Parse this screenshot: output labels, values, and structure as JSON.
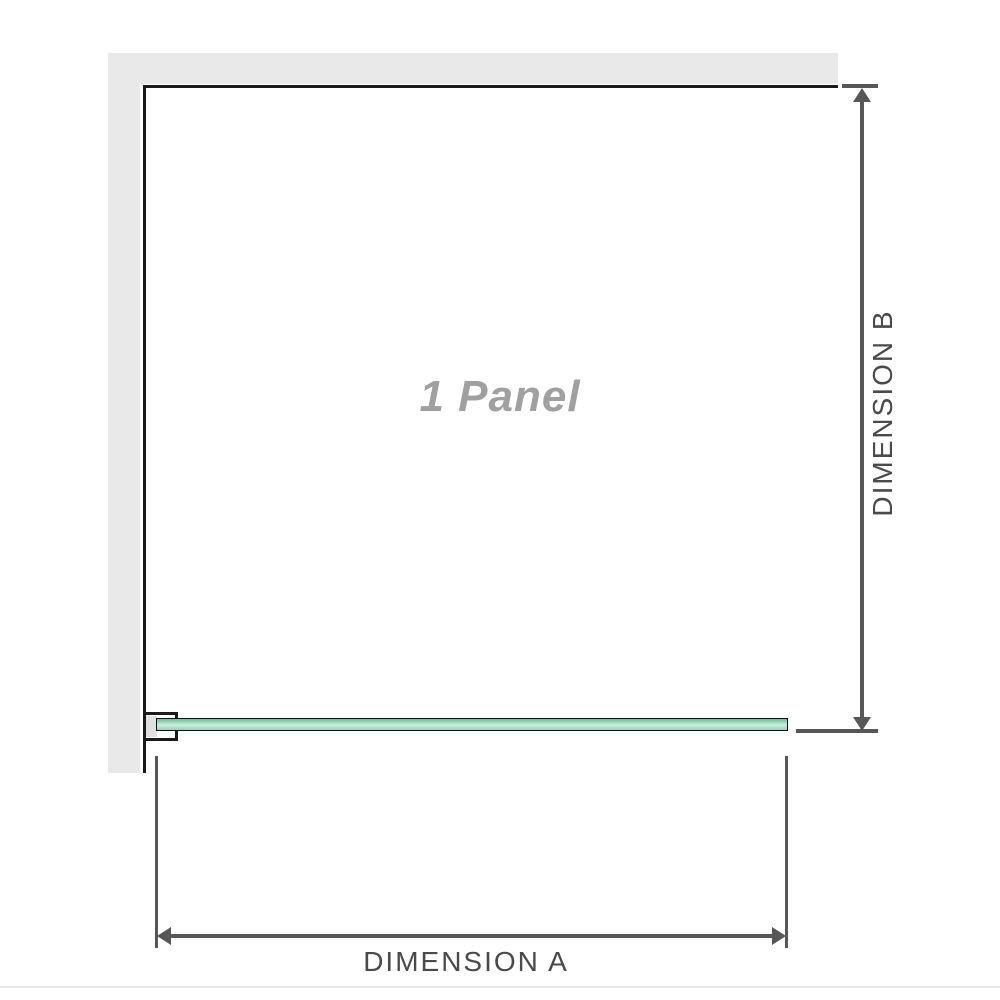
{
  "diagram": {
    "panel_label": "1 Panel",
    "dimension_a": {
      "label": "DIMENSION A",
      "orientation": "horizontal"
    },
    "dimension_b": {
      "label": "DIMENSION B",
      "orientation": "vertical"
    },
    "icons": {
      "arrow_up": "css-triangle-up",
      "arrow_down": "css-triangle-down",
      "arrow_left": "css-triangle-left",
      "arrow_right": "css-triangle-right"
    },
    "colors": {
      "wall": "#e9e9e9",
      "outline": "#1a1a1a",
      "dimension_line": "#575757",
      "dimension_text": "#4a4a4a",
      "panel_label_text": "#a0a0a0",
      "glass_green_dark": "#6fbf97",
      "glass_green_mid": "#93d3b3",
      "glass_green_light": "#cdeedd",
      "baseboard_line": "#ece8e1"
    }
  }
}
